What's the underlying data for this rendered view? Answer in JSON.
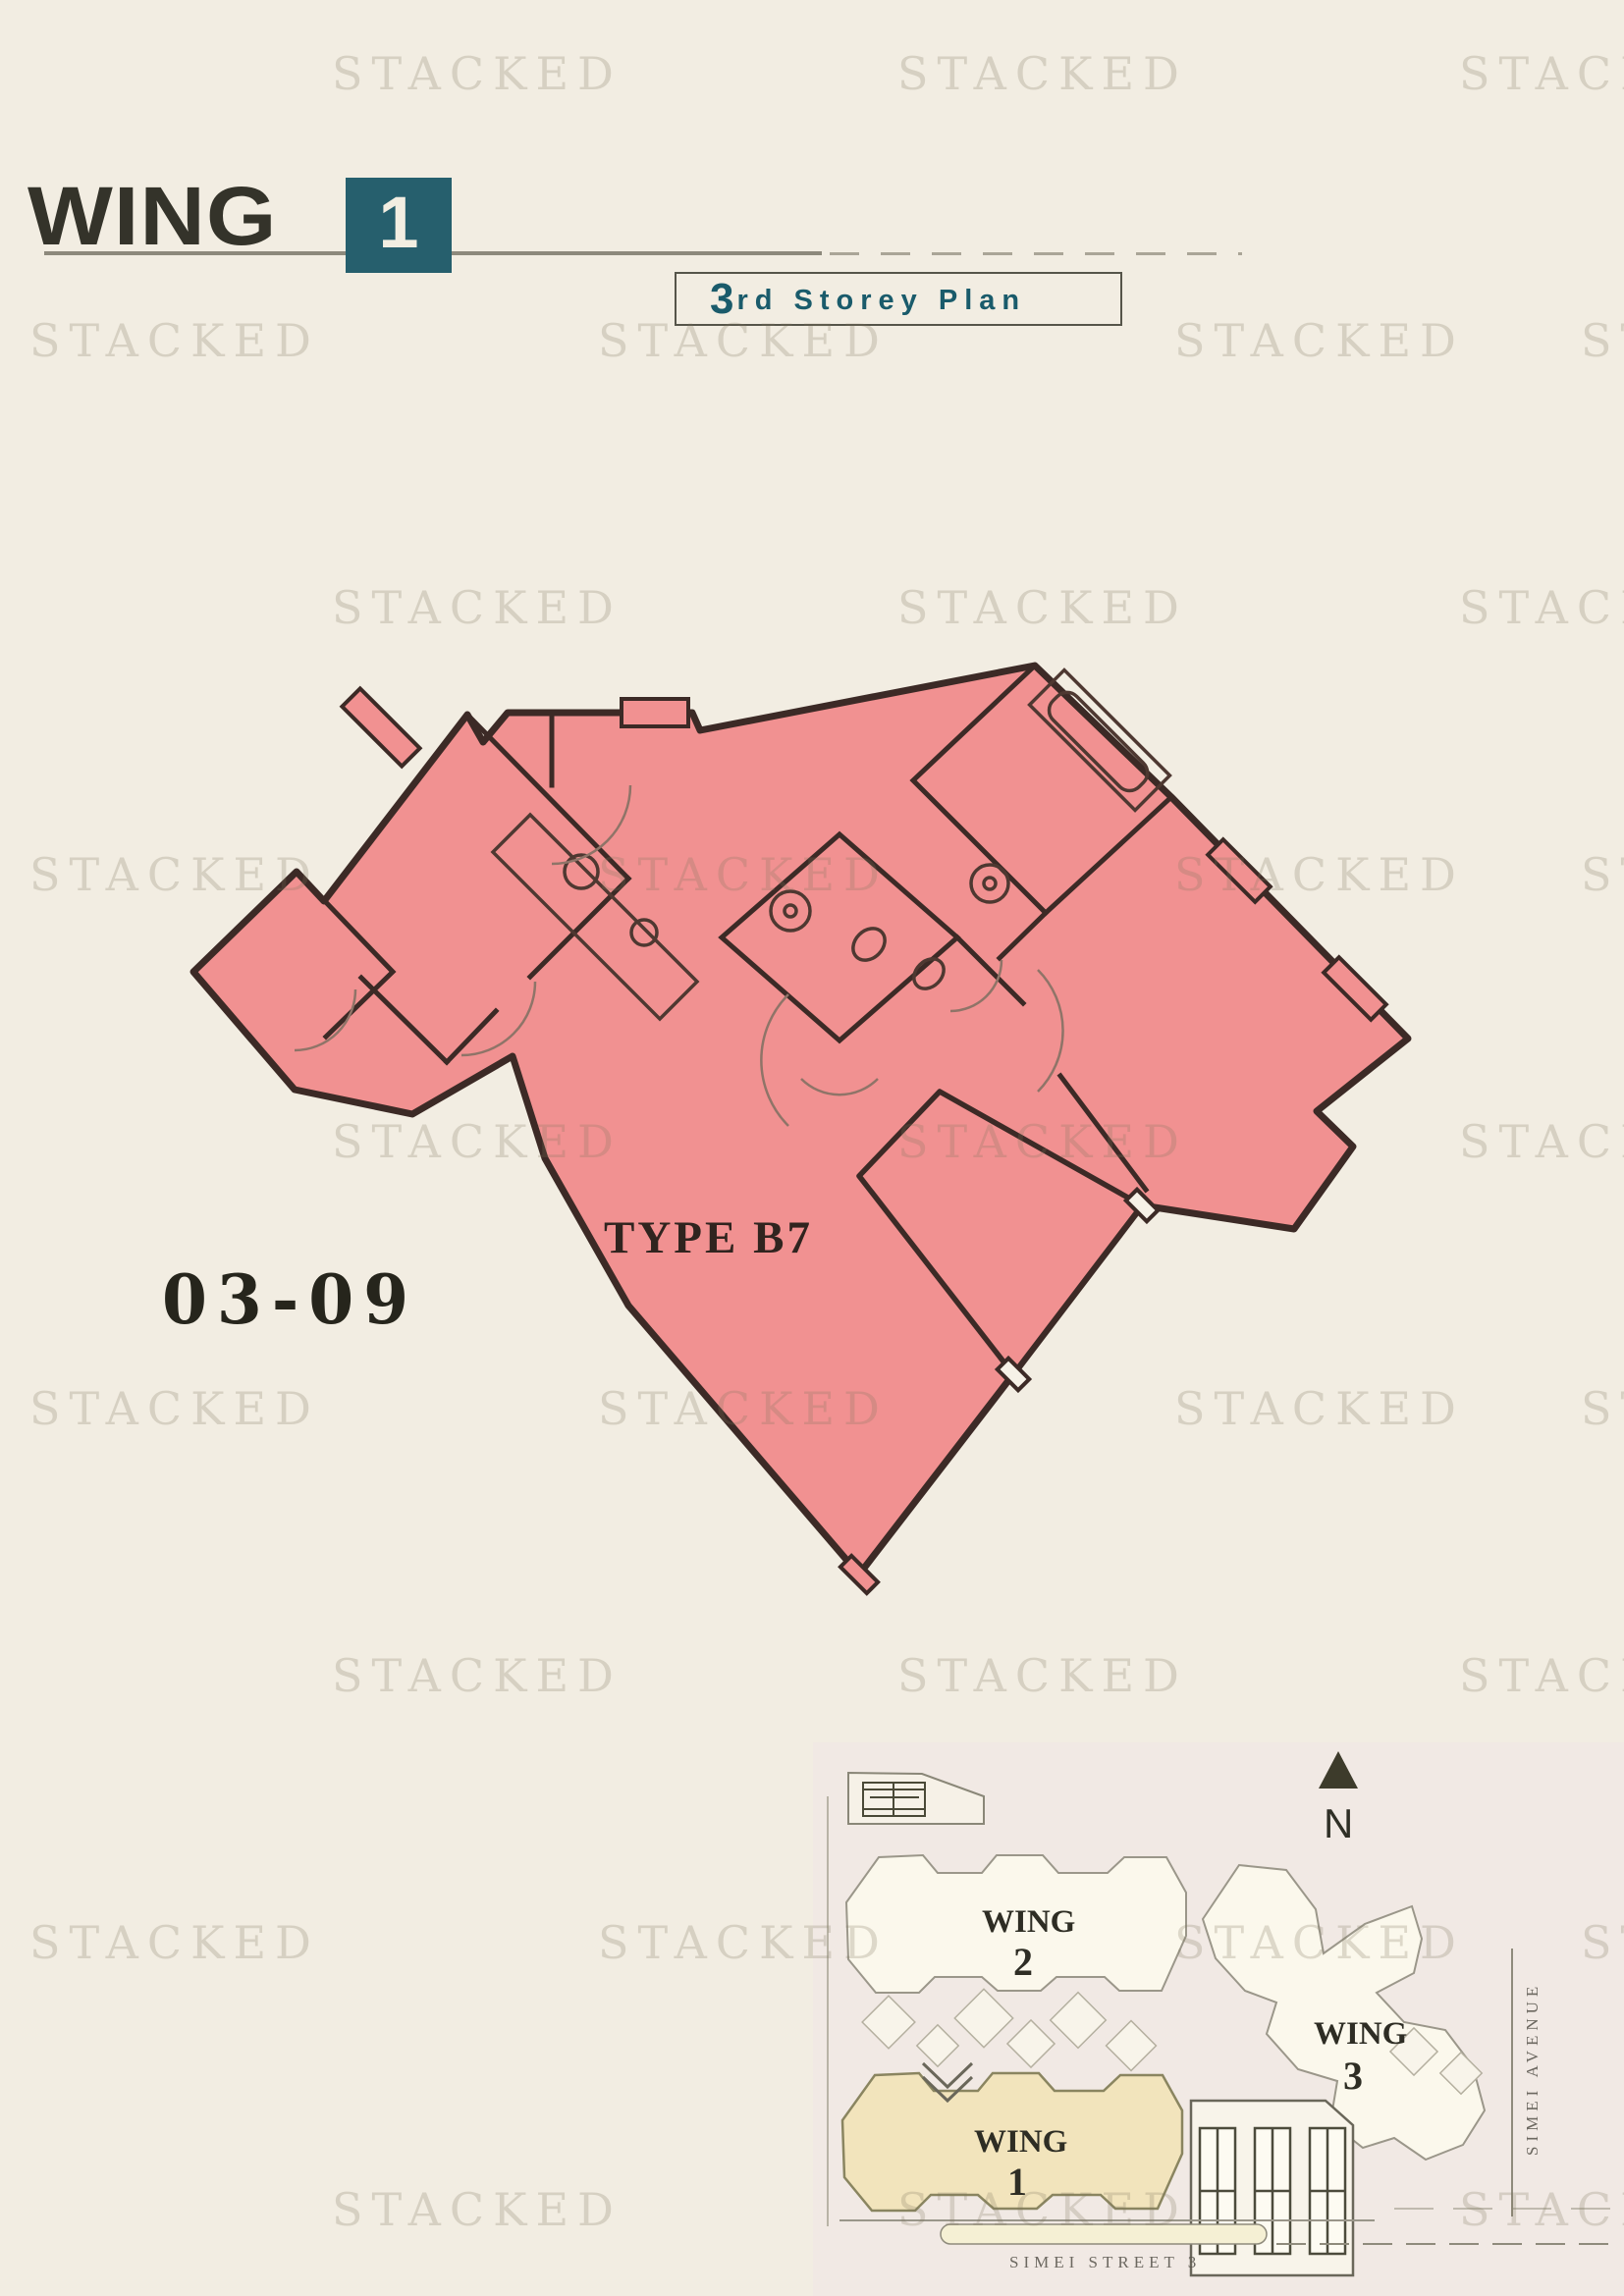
{
  "watermark": {
    "text": "STACKED"
  },
  "header": {
    "title": "WING",
    "wing_number": "1",
    "storey_number": "3",
    "storey_text": "rd Storey Plan"
  },
  "floor_plan": {
    "unit_label": "03-09",
    "type_label": "TYPE B7",
    "fill_color": "#f19191",
    "wall_color": "#3c2a26"
  },
  "site_plan": {
    "north_label": "N",
    "wings": [
      {
        "name": "WING",
        "number": "1"
      },
      {
        "name": "WING",
        "number": "2"
      },
      {
        "name": "WING",
        "number": "3"
      }
    ],
    "streets": {
      "bottom": "SIMEI STREET 3",
      "right": "SIMEI AVENUE"
    },
    "wing1_highlight": "#f2e4bc"
  },
  "colors": {
    "accent_teal": "#265f6d",
    "page_background": "#f2ede2",
    "plan_pink": "#f19191"
  }
}
